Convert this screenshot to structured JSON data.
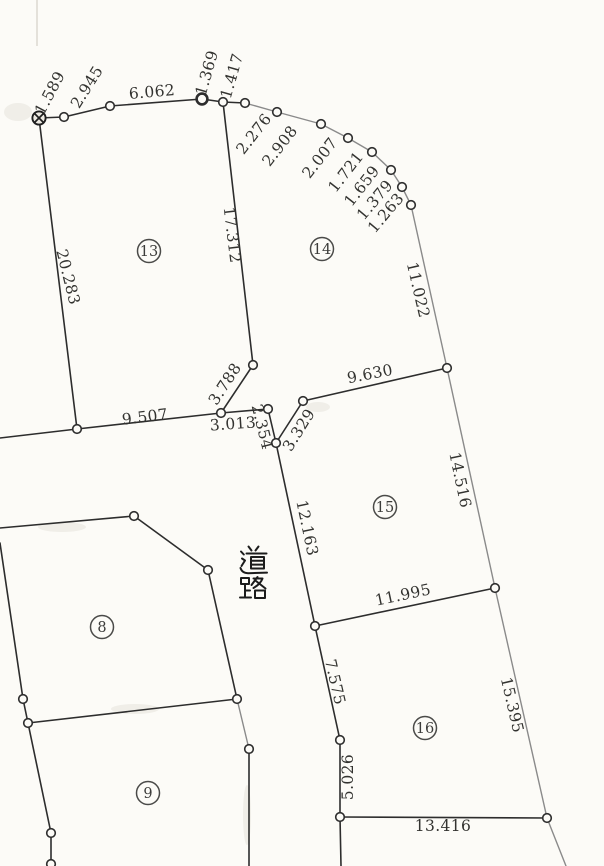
{
  "document": {
    "kind_note": "scanned cadastral survey plat",
    "road_label": "道路"
  },
  "diagram": {
    "canvas": {
      "width": 604,
      "height": 866,
      "paper_color": "#fcfbf7",
      "ink_color": "#2d2d2d",
      "light_ink_color": "#8a8a8a"
    },
    "road": {
      "label": "道路",
      "x": 238,
      "char_tops": [
        545,
        575
      ],
      "char_size": 30
    },
    "parcels": [
      {
        "number": "13",
        "x": 149,
        "y": 251
      },
      {
        "number": "14",
        "x": 322,
        "y": 249
      },
      {
        "number": "15",
        "x": 385,
        "y": 507
      },
      {
        "number": "8",
        "x": 102,
        "y": 627
      },
      {
        "number": "9",
        "x": 148,
        "y": 793
      },
      {
        "number": "16",
        "x": 425,
        "y": 728
      }
    ],
    "survey_marker": {
      "x": 39,
      "y": 118
    },
    "vertices": [
      {
        "x": 64,
        "y": 117
      },
      {
        "x": 110,
        "y": 106
      },
      {
        "x": 202,
        "y": 99,
        "bold": true
      },
      {
        "x": 223,
        "y": 102
      },
      {
        "x": 245,
        "y": 103
      },
      {
        "x": 277,
        "y": 112
      },
      {
        "x": 321,
        "y": 124
      },
      {
        "x": 348,
        "y": 138
      },
      {
        "x": 372,
        "y": 152
      },
      {
        "x": 391,
        "y": 170
      },
      {
        "x": 402,
        "y": 187
      },
      {
        "x": 411,
        "y": 205
      },
      {
        "x": 77,
        "y": 429
      },
      {
        "x": 221,
        "y": 413
      },
      {
        "x": 253,
        "y": 365
      },
      {
        "x": 268,
        "y": 409
      },
      {
        "x": 276,
        "y": 443
      },
      {
        "x": 303,
        "y": 401
      },
      {
        "x": 447,
        "y": 368
      },
      {
        "x": 495,
        "y": 588
      },
      {
        "x": 547,
        "y": 818
      },
      {
        "x": 315,
        "y": 626
      },
      {
        "x": 340,
        "y": 740
      },
      {
        "x": 340,
        "y": 817
      },
      {
        "x": 134,
        "y": 516
      },
      {
        "x": 208,
        "y": 570
      },
      {
        "x": 237,
        "y": 699
      },
      {
        "x": 23,
        "y": 699
      },
      {
        "x": 28,
        "y": 723
      },
      {
        "x": 51,
        "y": 833
      },
      {
        "x": 51,
        "y": 864
      },
      {
        "x": 249,
        "y": 749
      }
    ],
    "segments": [
      {
        "x1": 39,
        "y1": 118,
        "x2": 64,
        "y2": 117
      },
      {
        "x1": 64,
        "y1": 117,
        "x2": 110,
        "y2": 106
      },
      {
        "x1": 110,
        "y1": 106,
        "x2": 202,
        "y2": 99
      },
      {
        "x1": 202,
        "y1": 99,
        "x2": 223,
        "y2": 102
      },
      {
        "x1": 223,
        "y1": 102,
        "x2": 245,
        "y2": 103
      },
      {
        "x1": 245,
        "y1": 103,
        "x2": 277,
        "y2": 112,
        "light": true
      },
      {
        "x1": 277,
        "y1": 112,
        "x2": 321,
        "y2": 124,
        "light": true
      },
      {
        "x1": 321,
        "y1": 124,
        "x2": 348,
        "y2": 138,
        "light": true
      },
      {
        "x1": 348,
        "y1": 138,
        "x2": 372,
        "y2": 152,
        "light": true
      },
      {
        "x1": 372,
        "y1": 152,
        "x2": 391,
        "y2": 170,
        "light": true
      },
      {
        "x1": 391,
        "y1": 170,
        "x2": 402,
        "y2": 187,
        "light": true
      },
      {
        "x1": 402,
        "y1": 187,
        "x2": 411,
        "y2": 205,
        "light": true
      },
      {
        "x1": 411,
        "y1": 205,
        "x2": 447,
        "y2": 368,
        "light": true
      },
      {
        "x1": 447,
        "y1": 368,
        "x2": 495,
        "y2": 588,
        "light": true
      },
      {
        "x1": 495,
        "y1": 588,
        "x2": 547,
        "y2": 818,
        "light": true
      },
      {
        "x1": 547,
        "y1": 818,
        "x2": 566,
        "y2": 866,
        "light": true
      },
      {
        "x1": 39,
        "y1": 118,
        "x2": 77,
        "y2": 429
      },
      {
        "x1": 77,
        "y1": 429,
        "x2": 0,
        "y2": 438
      },
      {
        "x1": 77,
        "y1": 429,
        "x2": 221,
        "y2": 413
      },
      {
        "x1": 221,
        "y1": 413,
        "x2": 253,
        "y2": 365
      },
      {
        "x1": 223,
        "y1": 102,
        "x2": 253,
        "y2": 365
      },
      {
        "x1": 221,
        "y1": 413,
        "x2": 268,
        "y2": 409
      },
      {
        "x1": 268,
        "y1": 409,
        "x2": 276,
        "y2": 443
      },
      {
        "x1": 276,
        "y1": 443,
        "x2": 303,
        "y2": 401
      },
      {
        "x1": 303,
        "y1": 401,
        "x2": 447,
        "y2": 368
      },
      {
        "x1": 276,
        "y1": 443,
        "x2": 315,
        "y2": 626
      },
      {
        "x1": 315,
        "y1": 626,
        "x2": 495,
        "y2": 588
      },
      {
        "x1": 315,
        "y1": 626,
        "x2": 340,
        "y2": 740
      },
      {
        "x1": 340,
        "y1": 740,
        "x2": 340,
        "y2": 817
      },
      {
        "x1": 340,
        "y1": 817,
        "x2": 547,
        "y2": 818
      },
      {
        "x1": 340,
        "y1": 817,
        "x2": 341,
        "y2": 866
      },
      {
        "x1": 0,
        "y1": 528,
        "x2": 134,
        "y2": 516
      },
      {
        "x1": 134,
        "y1": 516,
        "x2": 208,
        "y2": 570
      },
      {
        "x1": 208,
        "y1": 570,
        "x2": 237,
        "y2": 699
      },
      {
        "x1": 0,
        "y1": 543,
        "x2": 23,
        "y2": 699
      },
      {
        "x1": 23,
        "y1": 699,
        "x2": 28,
        "y2": 723
      },
      {
        "x1": 28,
        "y1": 723,
        "x2": 237,
        "y2": 699
      },
      {
        "x1": 28,
        "y1": 723,
        "x2": 51,
        "y2": 833
      },
      {
        "x1": 51,
        "y1": 833,
        "x2": 51,
        "y2": 864
      },
      {
        "x1": 237,
        "y1": 699,
        "x2": 249,
        "y2": 749,
        "light": true
      },
      {
        "x1": 249,
        "y1": 749,
        "x2": 249,
        "y2": 866
      }
    ],
    "measurements": [
      {
        "value": "1.589",
        "x": 50,
        "y": 93,
        "rot": -62
      },
      {
        "value": "2.945",
        "x": 87,
        "y": 87,
        "rot": -58
      },
      {
        "value": "6.062",
        "x": 152,
        "y": 92,
        "rot": -5
      },
      {
        "value": "1.369",
        "x": 207,
        "y": 73,
        "rot": -74
      },
      {
        "value": "1.417",
        "x": 232,
        "y": 76,
        "rot": -74
      },
      {
        "value": "2.276",
        "x": 254,
        "y": 134,
        "rot": -52
      },
      {
        "value": "2.908",
        "x": 280,
        "y": 146,
        "rot": -52
      },
      {
        "value": "2.007",
        "x": 320,
        "y": 158,
        "rot": -52
      },
      {
        "value": "1.721",
        "x": 346,
        "y": 172,
        "rot": -52
      },
      {
        "value": "1.659",
        "x": 362,
        "y": 186,
        "rot": -52
      },
      {
        "value": "1.379",
        "x": 375,
        "y": 200,
        "rot": -50
      },
      {
        "value": "1.263",
        "x": 386,
        "y": 213,
        "rot": -50
      },
      {
        "value": "20.283",
        "x": 68,
        "y": 277,
        "rot": 76
      },
      {
        "value": "17.312",
        "x": 232,
        "y": 235,
        "rot": 83
      },
      {
        "value": "11.022",
        "x": 418,
        "y": 290,
        "rot": 77
      },
      {
        "value": "9.507",
        "x": 145,
        "y": 417,
        "rot": -7
      },
      {
        "value": "3.788",
        "x": 225,
        "y": 384,
        "rot": -57
      },
      {
        "value": "3.013",
        "x": 233,
        "y": 424,
        "rot": -4
      },
      {
        "value": "2.354",
        "x": 262,
        "y": 427,
        "rot": 76
      },
      {
        "value": "3.329",
        "x": 299,
        "y": 430,
        "rot": -58
      },
      {
        "value": "9.630",
        "x": 370,
        "y": 374,
        "rot": -11
      },
      {
        "value": "14.516",
        "x": 460,
        "y": 480,
        "rot": 78
      },
      {
        "value": "12.163",
        "x": 307,
        "y": 528,
        "rot": 78
      },
      {
        "value": "11.995",
        "x": 403,
        "y": 595,
        "rot": -12
      },
      {
        "value": "15.395",
        "x": 512,
        "y": 705,
        "rot": 77
      },
      {
        "value": "7.575",
        "x": 335,
        "y": 682,
        "rot": 77
      },
      {
        "value": "5.026",
        "x": 348,
        "y": 777,
        "rot": -90
      },
      {
        "value": "13.416",
        "x": 443,
        "y": 826,
        "rot": 0
      }
    ]
  }
}
